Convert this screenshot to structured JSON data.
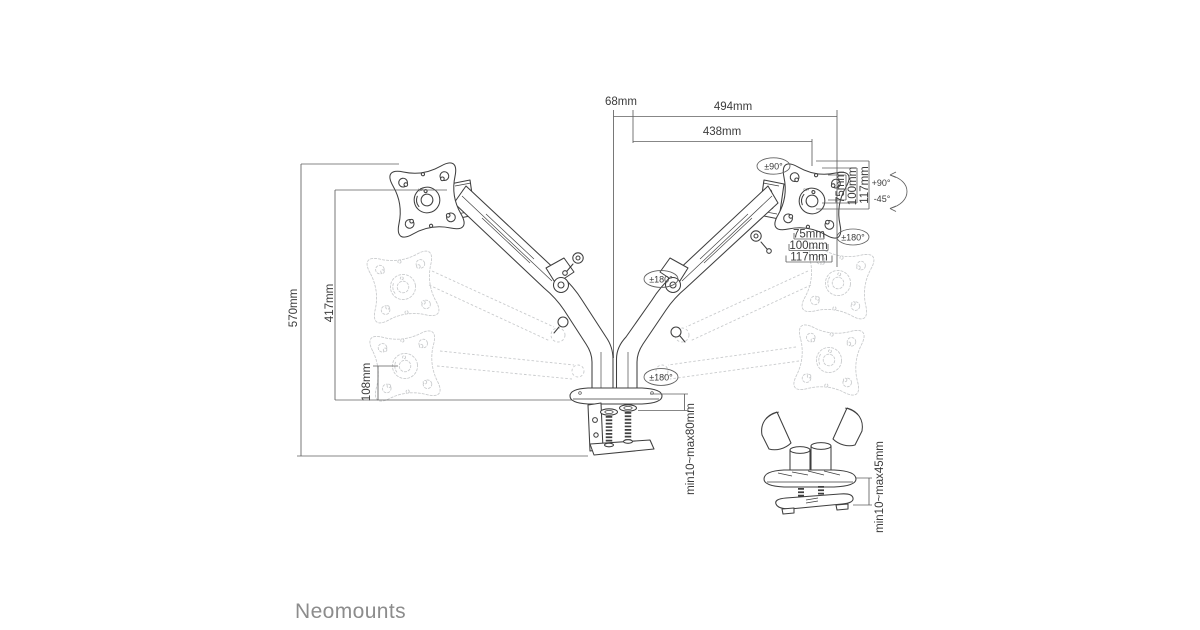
{
  "brand": {
    "logo": "Neomounts"
  },
  "dimensions": {
    "pole_offset": "68mm",
    "max_reach": "494mm",
    "arm_reach": "438mm",
    "max_height": "570mm",
    "mid_height": "417mm",
    "min_height": "108mm",
    "clamp_thickness_range": "min10~max80mm",
    "grommet_thickness_range": "min10~max45mm"
  },
  "vesa": {
    "sizes": [
      "75mm",
      "100mm",
      "117mm"
    ]
  },
  "angles": {
    "swivel": "±90°",
    "rotation": "±180°",
    "tilt_up": "+90°",
    "tilt_down": "-45°"
  },
  "plate_marking": "UP"
}
